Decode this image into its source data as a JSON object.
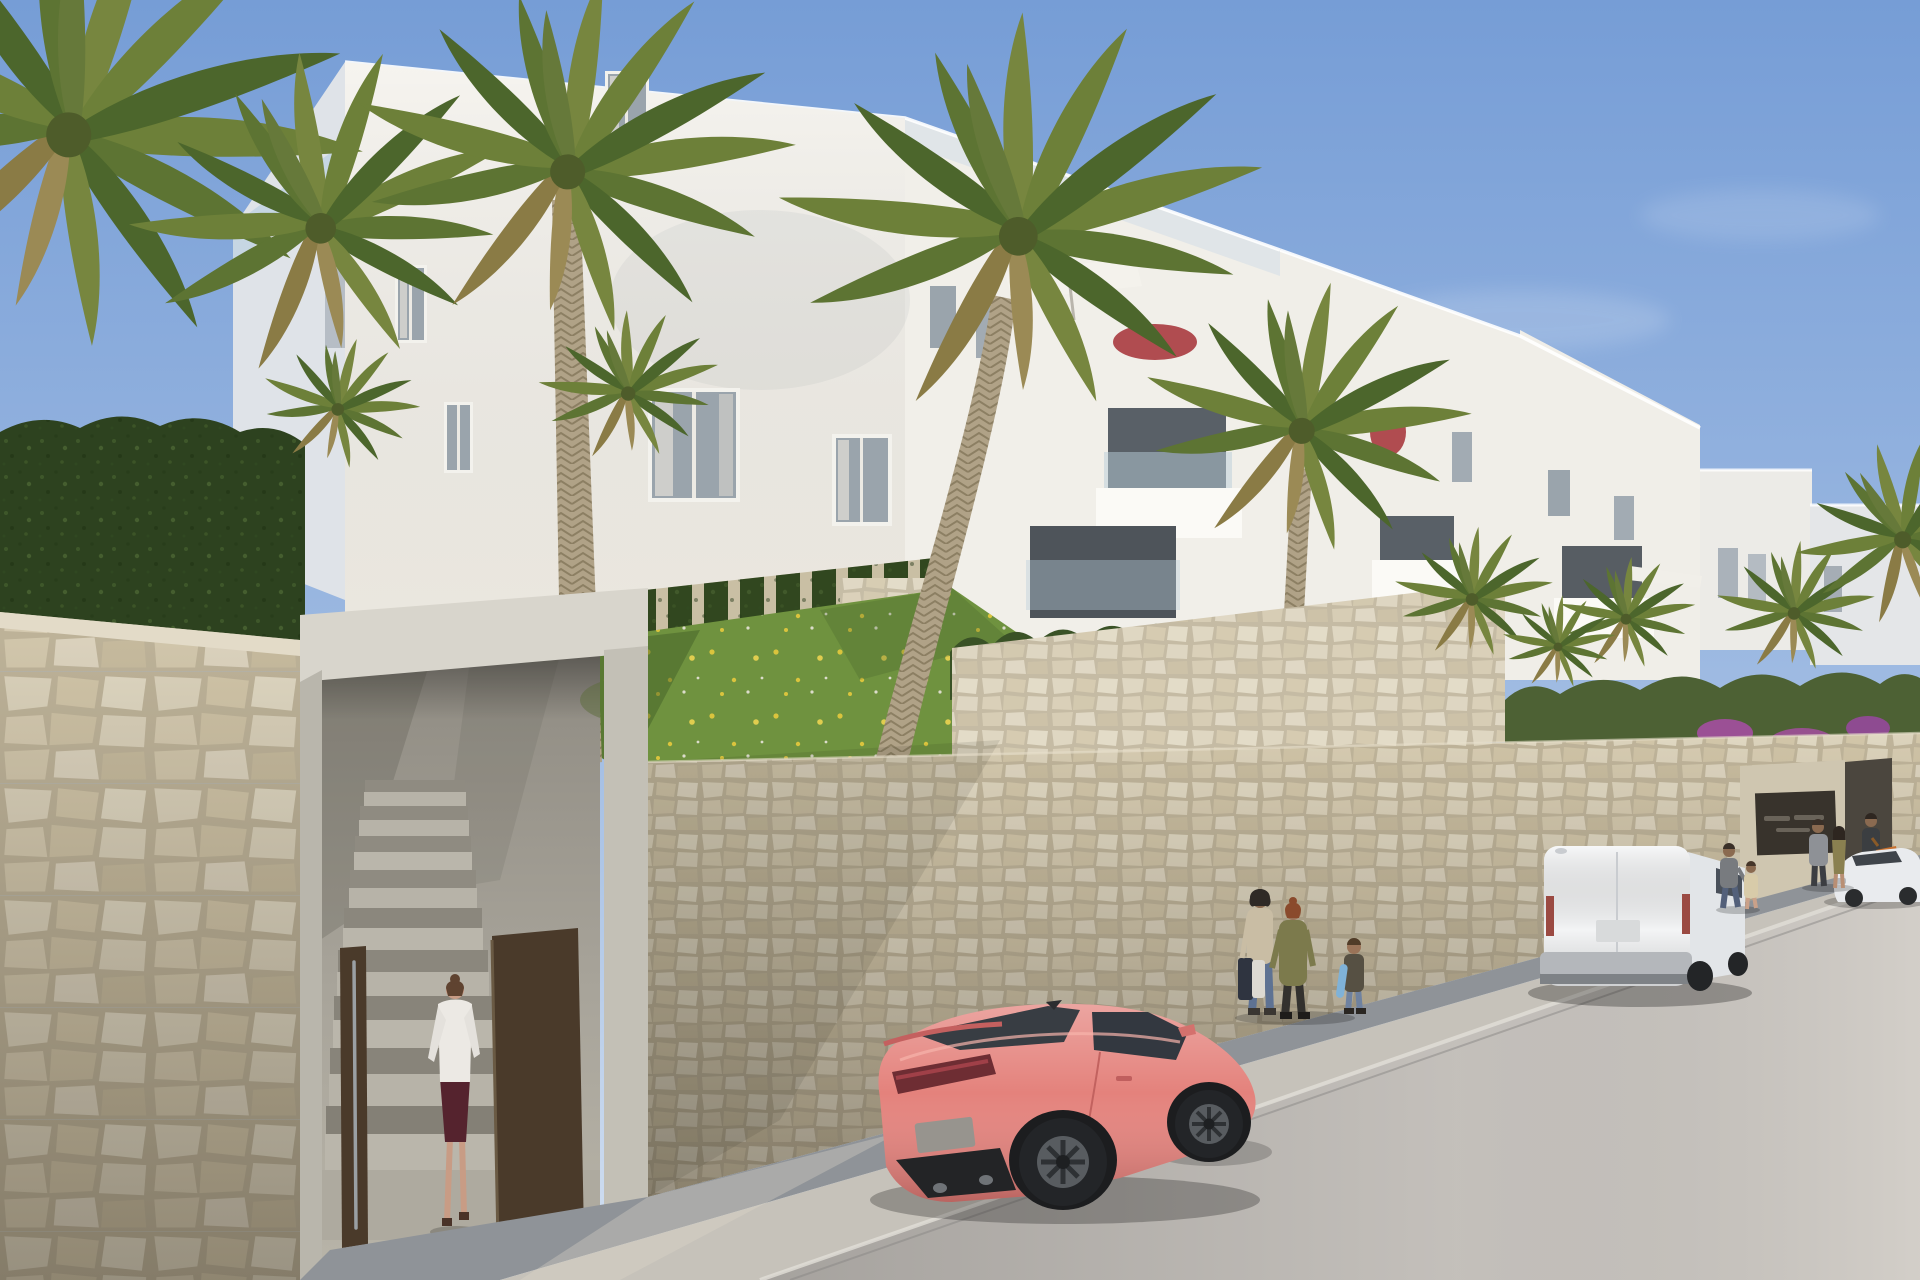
{
  "scene": {
    "kind": "photorealistic architectural exterior render",
    "setting": "new-build white apartment complex on a hillside street with stone retaining walls, palm trees, parked vehicles and pedestrians",
    "sky": "clear sunny blue sky",
    "road": "asphalt street rising uphill to the right with sidewalk and curb"
  },
  "colors": {
    "sky_top": "#769dd6",
    "sky_horizon": "#d3e0f1",
    "building_sunlit": "#f6f4ef",
    "building_mid": "#f1efe9",
    "building_right": "#f0eee8",
    "building_far": "#ecebe7",
    "building_shaded": "#dfe3e8",
    "balcony_recess": "#596067",
    "parapet_white": "#fbfaf6",
    "window_glass": "#9aa4ac",
    "stone_mortar": "#bfb49a",
    "stone_light": "#dcd3bc",
    "concrete_portal": "#d8d5cc",
    "portal_interior": "#a8a49a",
    "door_brown": "#4a3a2a",
    "grass_green": "#6f923f",
    "flower_yellow": "#e6c93d",
    "hedge_dark": "#2d421f",
    "ivy_green": "#31471f",
    "cypress_green": "#3a5226",
    "palm_green": "#66793a",
    "palm_trunk": "#b0a287",
    "bougainvillea_red": "#a83a3f",
    "bougainvillea_purple": "#a44fa0",
    "sidewalk_shade": "#8f9398",
    "road_light": "#c9c5c0",
    "car_body": "#e4827c",
    "car_glass": "#383d43",
    "van_body": "#f3f4f5",
    "van_trim": "#b4b7bb",
    "sedan_body": "#e9ebee",
    "scooter_orange": "#c8702e",
    "skateboard_blue": "#7fb2d8",
    "sign_dark": "#38332c",
    "parasol_white": "#f4f2ec"
  },
  "objects": {
    "buildings": {
      "count": 4,
      "style": "modern white terraced apartment blocks stepping downhill, recessed balconies, glass balustrades, roof terraces",
      "features": [
        "white parasol on roof terrace",
        "red bougainvillea",
        "purple bougainvillea",
        "ivy-clad garden wall",
        "cypress hedge",
        "stone-clad planter walls"
      ]
    },
    "vehicles": [
      {
        "kind": "sports coupe",
        "color_name": "coral pink",
        "position": "foreground, parked on street facing right"
      },
      {
        "kind": "panel van",
        "color_name": "white",
        "position": "mid distance, parked along the wall"
      },
      {
        "kind": "sedan",
        "color_name": "white",
        "position": "far right, parked uphill"
      },
      {
        "kind": "moped",
        "color_name": "orange",
        "position": "far right sidewalk"
      }
    ],
    "people": [
      {
        "who": "woman in white blouse and dark skirt",
        "action": "walking through open gate up entrance steps"
      },
      {
        "who": "woman carrying shopping bags",
        "action": "standing on sidewalk by wall"
      },
      {
        "who": "woman in olive jacket",
        "action": "standing talking"
      },
      {
        "who": "child holding blue skateboard",
        "action": "standing by wall"
      },
      {
        "who": "man with small child",
        "action": "walking uphill on sidewalk"
      },
      {
        "who": "couple",
        "action": "standing near entrance sign"
      },
      {
        "who": "rider",
        "action": "standing beside orange moped"
      }
    ],
    "entrance": {
      "gate": "dark brown metal gate standing open",
      "stairs": "concrete steps rising to garden level",
      "sign": "dark wall-mounted nameplate, text not legible"
    }
  }
}
